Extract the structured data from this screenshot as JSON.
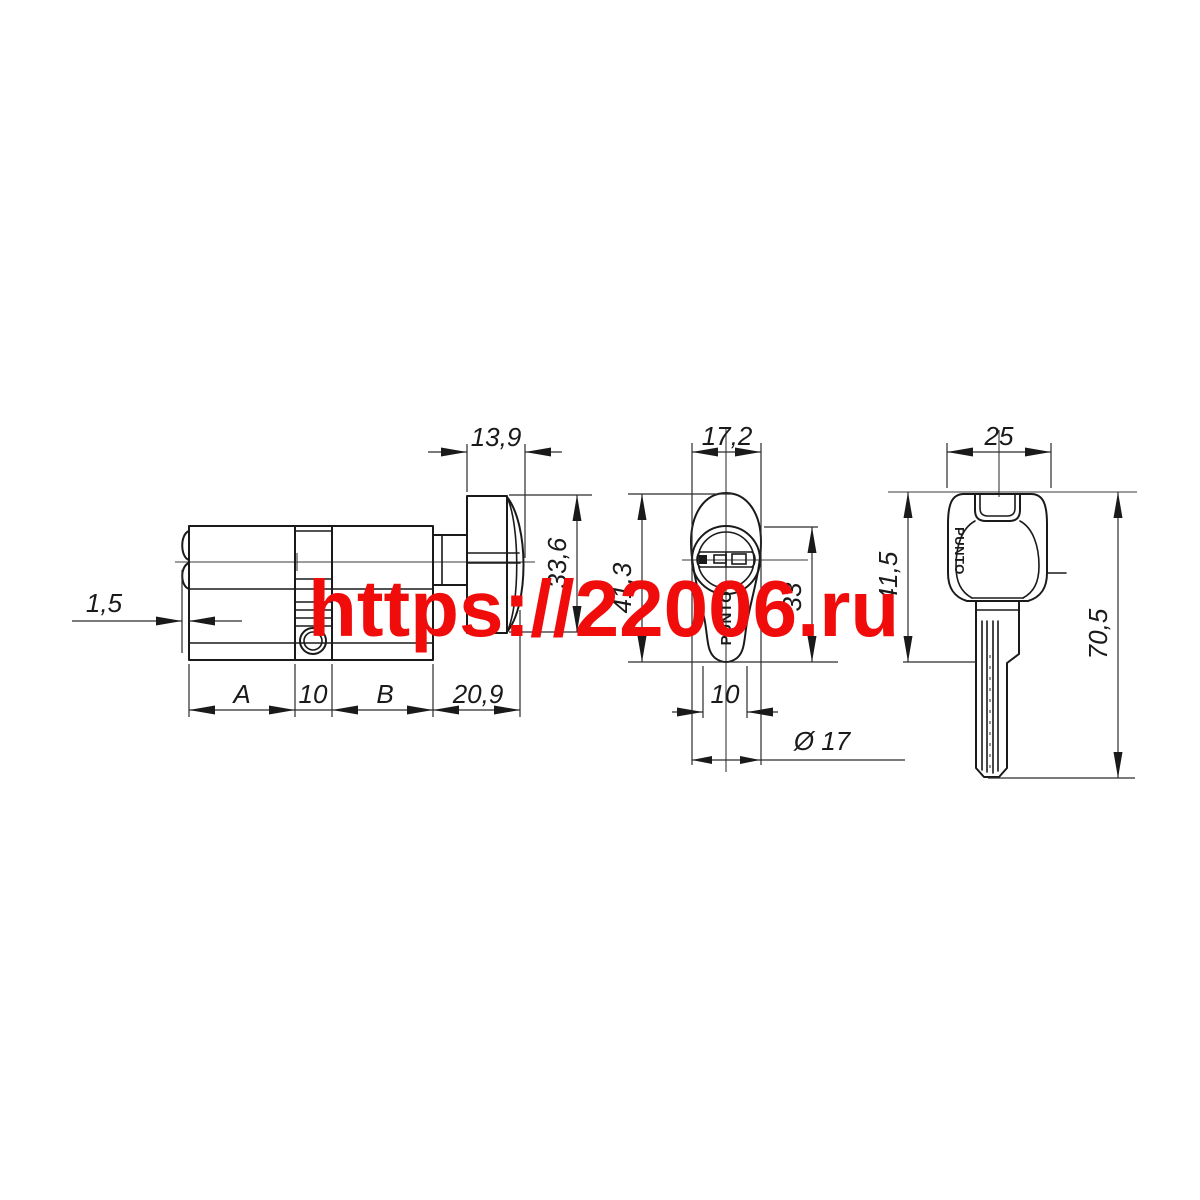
{
  "watermark": {
    "text": "https://22006.ru",
    "color": "#f10c0c"
  },
  "drawing": {
    "line_color": "#1a1a1a",
    "brand": "PUNTO",
    "views": {
      "side": {
        "dims": {
          "turn_width": "13,9",
          "face_protrusion": "1,5",
          "turn_height": "33,6",
          "a": "A",
          "center": "10",
          "b": "B",
          "turn_length": "20,9"
        }
      },
      "end": {
        "dims": {
          "width": "17,2",
          "height": "41,3",
          "plug_height": "33",
          "foot_width": "10",
          "diameter": "Ø 17"
        }
      },
      "key": {
        "dims": {
          "head_width": "25",
          "head_height": "41,5",
          "length": "70,5"
        }
      }
    }
  }
}
